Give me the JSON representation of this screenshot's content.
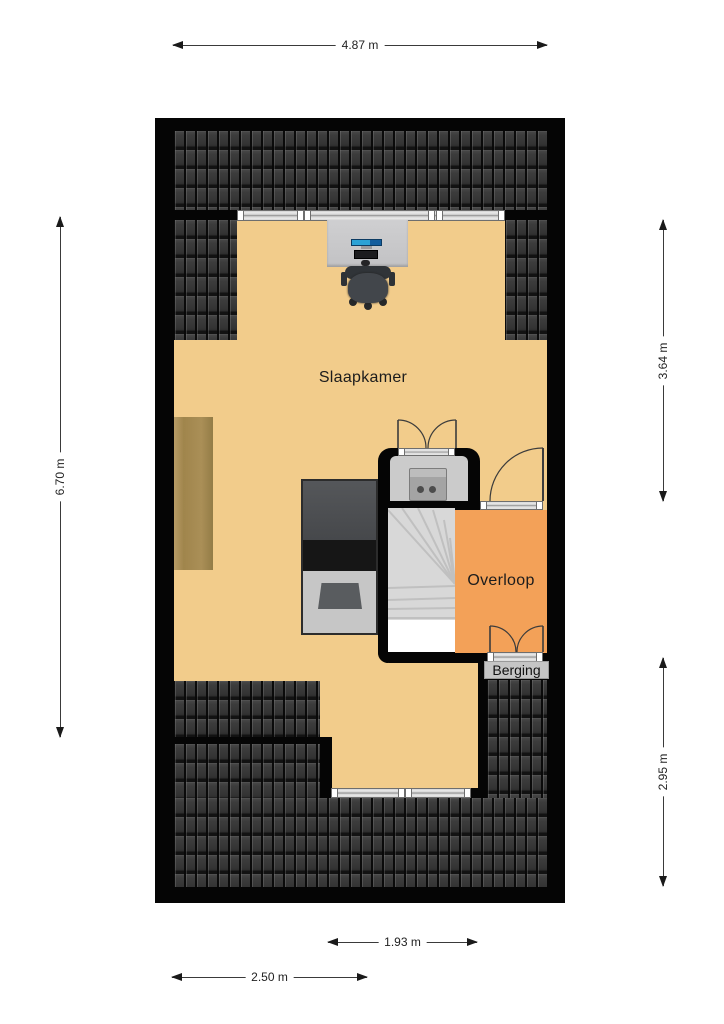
{
  "plan_title": "floor-plan-attic",
  "labels": {
    "bedroom": "Slaapkamer",
    "landing": "Overloop",
    "storage": "Berging"
  },
  "dimensions": {
    "top_width": "4.87 m",
    "left_height": "6.70 m",
    "right_upper_height": "3.64 m",
    "right_lower_height": "2.95 m",
    "bottom_inner_width": "1.93 m",
    "bottom_outer_width": "2.50 m"
  },
  "colors": {
    "wall": "#050505",
    "bedroom_floor": "#f2cc8b",
    "landing_floor": "#f3a158",
    "roof_tiles": "#333333",
    "stairs": "#d8d8d8",
    "wardrobe_wood": "#a98e55",
    "monitor_screen_blue": "#2ba2d6"
  },
  "furniture": [
    "desk",
    "monitor",
    "office-chair",
    "bed",
    "wardrobe",
    "washing-machine",
    "winder-stairs"
  ]
}
